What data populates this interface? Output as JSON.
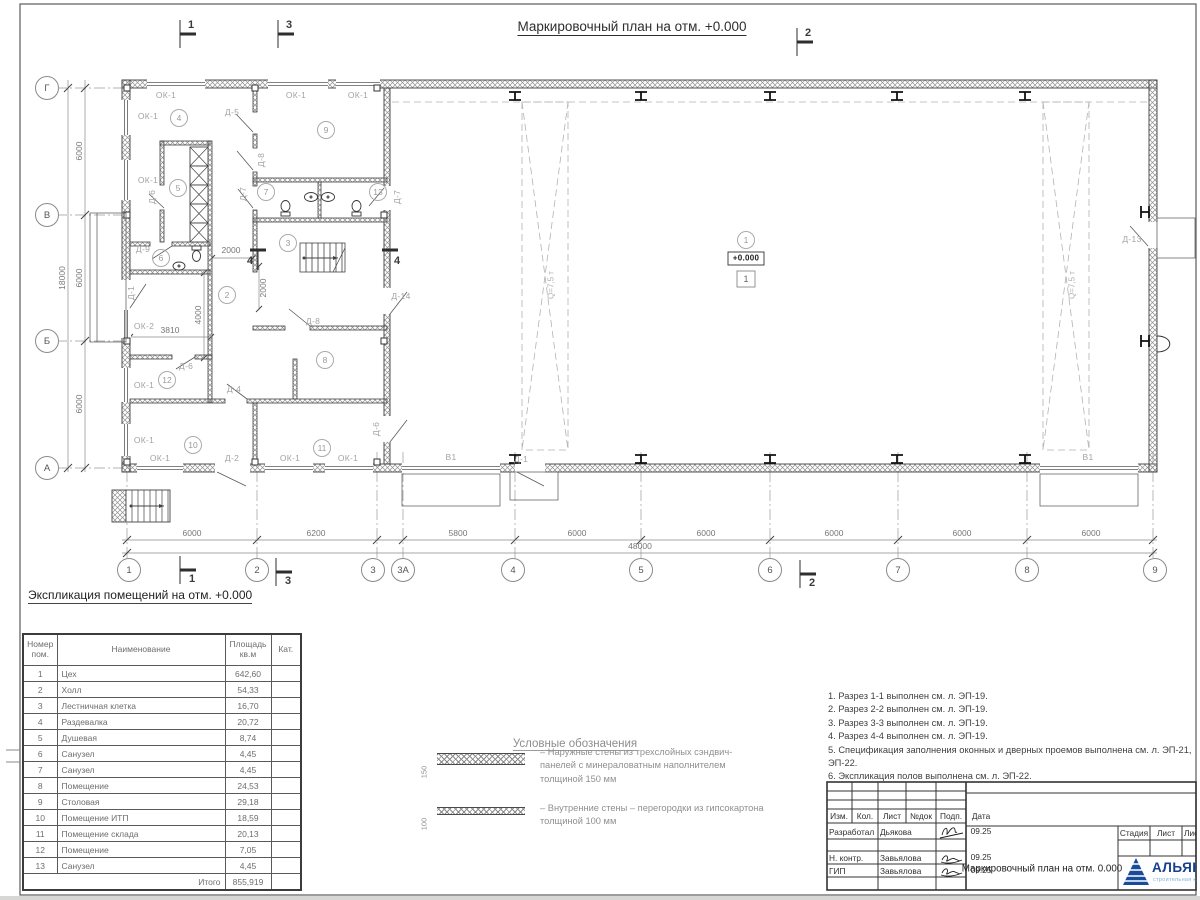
{
  "page_title": "Маркировочный план на отм. +0.000",
  "plan": {
    "grid_bottom": [
      {
        "label": "1",
        "x": 129,
        "y": 570
      },
      {
        "label": "2",
        "x": 257,
        "y": 570
      },
      {
        "label": "3",
        "x": 373,
        "y": 570
      },
      {
        "label": "3А",
        "x": 403,
        "y": 570
      },
      {
        "label": "4",
        "x": 513,
        "y": 570
      },
      {
        "label": "5",
        "x": 641,
        "y": 570
      },
      {
        "label": "6",
        "x": 770,
        "y": 570
      },
      {
        "label": "7",
        "x": 898,
        "y": 570
      },
      {
        "label": "8",
        "x": 1027,
        "y": 570
      },
      {
        "label": "9",
        "x": 1155,
        "y": 570
      }
    ],
    "grid_left": [
      {
        "label": "Г",
        "x": 47,
        "y": 88
      },
      {
        "label": "В",
        "x": 47,
        "y": 215
      },
      {
        "label": "Б",
        "x": 47,
        "y": 341
      },
      {
        "label": "А",
        "x": 47,
        "y": 468
      }
    ],
    "rooms": [
      {
        "n": "1",
        "x": 746,
        "y": 240
      },
      {
        "n": "2",
        "x": 227,
        "y": 295
      },
      {
        "n": "3",
        "x": 288,
        "y": 243
      },
      {
        "n": "4",
        "x": 179,
        "y": 118
      },
      {
        "n": "5",
        "x": 178,
        "y": 188
      },
      {
        "n": "6",
        "x": 161,
        "y": 258
      },
      {
        "n": "7",
        "x": 266,
        "y": 192
      },
      {
        "n": "8",
        "x": 325,
        "y": 360
      },
      {
        "n": "9",
        "x": 326,
        "y": 130
      },
      {
        "n": "10",
        "x": 193,
        "y": 445
      },
      {
        "n": "11",
        "x": 322,
        "y": 448
      },
      {
        "n": "12",
        "x": 167,
        "y": 380
      },
      {
        "n": "13",
        "x": 378,
        "y": 192
      }
    ],
    "door_window_labels": [
      {
        "t": "ОК-1",
        "x": 166,
        "y": 95
      },
      {
        "t": "ОК-1",
        "x": 296,
        "y": 95
      },
      {
        "t": "ОК-1",
        "x": 358,
        "y": 95
      },
      {
        "t": "ОК-1",
        "x": 148,
        "y": 116
      },
      {
        "t": "ОК-1",
        "x": 148,
        "y": 180
      },
      {
        "t": "ОК-2",
        "x": 144,
        "y": 326
      },
      {
        "t": "ОК-1",
        "x": 144,
        "y": 385
      },
      {
        "t": "ОК-1",
        "x": 144,
        "y": 440
      },
      {
        "t": "ОК-1",
        "x": 160,
        "y": 458
      },
      {
        "t": "Д-2",
        "x": 232,
        "y": 458
      },
      {
        "t": "ОК-1",
        "x": 290,
        "y": 458
      },
      {
        "t": "ОК-1",
        "x": 348,
        "y": 458
      },
      {
        "t": "В1",
        "x": 451,
        "y": 457
      },
      {
        "t": "Д-1",
        "x": 521,
        "y": 459
      },
      {
        "t": "В1",
        "x": 1088,
        "y": 457
      },
      {
        "t": "Д-5",
        "x": 232,
        "y": 112
      },
      {
        "t": "Д-8",
        "x": 261,
        "y": 160,
        "r": 1
      },
      {
        "t": "Д-6",
        "x": 152,
        "y": 197,
        "r": 1
      },
      {
        "t": "Д-7",
        "x": 243,
        "y": 194,
        "r": 1
      },
      {
        "t": "Д-7",
        "x": 397,
        "y": 197,
        "r": 1
      },
      {
        "t": "Д-8",
        "x": 313,
        "y": 321
      },
      {
        "t": "Д-9",
        "x": 143,
        "y": 249
      },
      {
        "t": "Д-6",
        "x": 186,
        "y": 366
      },
      {
        "t": "Д-4",
        "x": 234,
        "y": 389
      },
      {
        "t": "Д-6",
        "x": 376,
        "y": 429,
        "r": 1
      },
      {
        "t": "Д-14",
        "x": 401,
        "y": 296
      },
      {
        "t": "Д-1",
        "x": 131,
        "y": 293,
        "r": 1
      },
      {
        "t": "Д-13",
        "x": 1132,
        "y": 239
      }
    ],
    "dimension_labels": [
      {
        "t": "2000",
        "x": 231,
        "y": 250
      },
      {
        "t": "2000",
        "x": 263,
        "y": 288,
        "r": 1
      },
      {
        "t": "4000",
        "x": 198,
        "y": 315,
        "r": 1
      },
      {
        "t": "3810",
        "x": 170,
        "y": 330
      },
      {
        "t": "6000",
        "x": 192,
        "y": 533
      },
      {
        "t": "6200",
        "x": 316,
        "y": 533
      },
      {
        "t": "5800",
        "x": 458,
        "y": 533
      },
      {
        "t": "6000",
        "x": 577,
        "y": 533
      },
      {
        "t": "6000",
        "x": 706,
        "y": 533
      },
      {
        "t": "6000",
        "x": 834,
        "y": 533
      },
      {
        "t": "6000",
        "x": 962,
        "y": 533
      },
      {
        "t": "6000",
        "x": 1091,
        "y": 533
      },
      {
        "t": "48000",
        "x": 640,
        "y": 546
      },
      {
        "t": "6000",
        "x": 79,
        "y": 151,
        "r": 1
      },
      {
        "t": "6000",
        "x": 79,
        "y": 278,
        "r": 1
      },
      {
        "t": "6000",
        "x": 79,
        "y": 404,
        "r": 1
      },
      {
        "t": "18000",
        "x": 62,
        "y": 278,
        "r": 1
      }
    ],
    "crane_labels": [
      {
        "t": "Q=7,5 т",
        "x": 551,
        "y": 285,
        "r": 1
      },
      {
        "t": "Q=7,5 т",
        "x": 1072,
        "y": 285,
        "r": 1
      }
    ],
    "section_labels": [
      {
        "t": "1",
        "x": 191,
        "y": 25
      },
      {
        "t": "3",
        "x": 289,
        "y": 25
      },
      {
        "t": "2",
        "x": 808,
        "y": 33
      },
      {
        "t": "1",
        "x": 192,
        "y": 579
      },
      {
        "t": "3",
        "x": 288,
        "y": 581
      },
      {
        "t": "2",
        "x": 812,
        "y": 583
      },
      {
        "t": "4",
        "x": 250,
        "y": 261
      },
      {
        "t": "4",
        "x": 397,
        "y": 261
      }
    ],
    "elevation_mark": "+0.000",
    "floor_type_mark": "1"
  },
  "schedule": {
    "heading": "Экспликация помещений на отм. +0.000",
    "headers": {
      "num": "Номер пом.",
      "name": "Наименование",
      "area": "Площадь кв.м",
      "cat": "Кат."
    },
    "rows": [
      {
        "num": "1",
        "name": "Цех",
        "area": "642,60"
      },
      {
        "num": "2",
        "name": "Холл",
        "area": "54,33"
      },
      {
        "num": "3",
        "name": "Лестничная клетка",
        "area": "16,70"
      },
      {
        "num": "4",
        "name": "Раздевалка",
        "area": "20,72"
      },
      {
        "num": "5",
        "name": "Душевая",
        "area": "8,74"
      },
      {
        "num": "6",
        "name": "Санузел",
        "area": "4,45"
      },
      {
        "num": "7",
        "name": "Санузел",
        "area": "4,45"
      },
      {
        "num": "8",
        "name": "Помещение",
        "area": "24,53"
      },
      {
        "num": "9",
        "name": "Столовая",
        "area": "29,18"
      },
      {
        "num": "10",
        "name": "Помещение ИТП",
        "area": "18,59"
      },
      {
        "num": "11",
        "name": "Помещение склада",
        "area": "20,13"
      },
      {
        "num": "12",
        "name": "Помещение",
        "area": "7,05"
      },
      {
        "num": "13",
        "name": "Санузел",
        "area": "4,45"
      }
    ],
    "total_label": "Итого",
    "total_area": "855,919"
  },
  "legend": {
    "title": "Условные обозначения",
    "items": [
      {
        "dim": "150",
        "text": "– Наружные стены из трехслойных сэндвич-панелей с минераловатным наполнителем толщиной 150 мм"
      },
      {
        "dim": "100",
        "text": "– Внутренние стены – перегородки из гипсокартона толщиной 100 мм"
      }
    ]
  },
  "notes": [
    {
      "t": "1. Разрез 1-1 выполнен см. л. ЭП-19."
    },
    {
      "t": "2. Разрез 2-2 выполнен см. л. ЭП-19."
    },
    {
      "t": "3. Разрез 3-3 выполнен см. л. ЭП-19."
    },
    {
      "t": "4. Разрез 4-4 выполнен см. л. ЭП-19."
    },
    {
      "t": "5. Спецификация заполнения оконных и дверных проемов выполнена см. л. ЭП-21, ЭП-22."
    },
    {
      "t": "6. Экспликация полов выполнена см. л. ЭП-22."
    }
  ],
  "titleblock": {
    "cols": [
      "Изм.",
      "Кол.",
      "Лист",
      "№док",
      "Подп.",
      "Дата"
    ],
    "rows": [
      {
        "role": "Разработал",
        "name": "Дьякова",
        "date": "09.25"
      },
      {
        "role": "Н. контр.",
        "name": "Завьялова",
        "date": "09.25"
      },
      {
        "role": "ГИП",
        "name": "Завьялова",
        "date": "09.25"
      }
    ],
    "doc_title": "Маркировочный план на отм. 0.000",
    "stage_cols": [
      "Стадия",
      "Лист",
      "Листов"
    ],
    "logo_text": "АЛЬЯНС",
    "logo_sub": "строительная компания"
  }
}
